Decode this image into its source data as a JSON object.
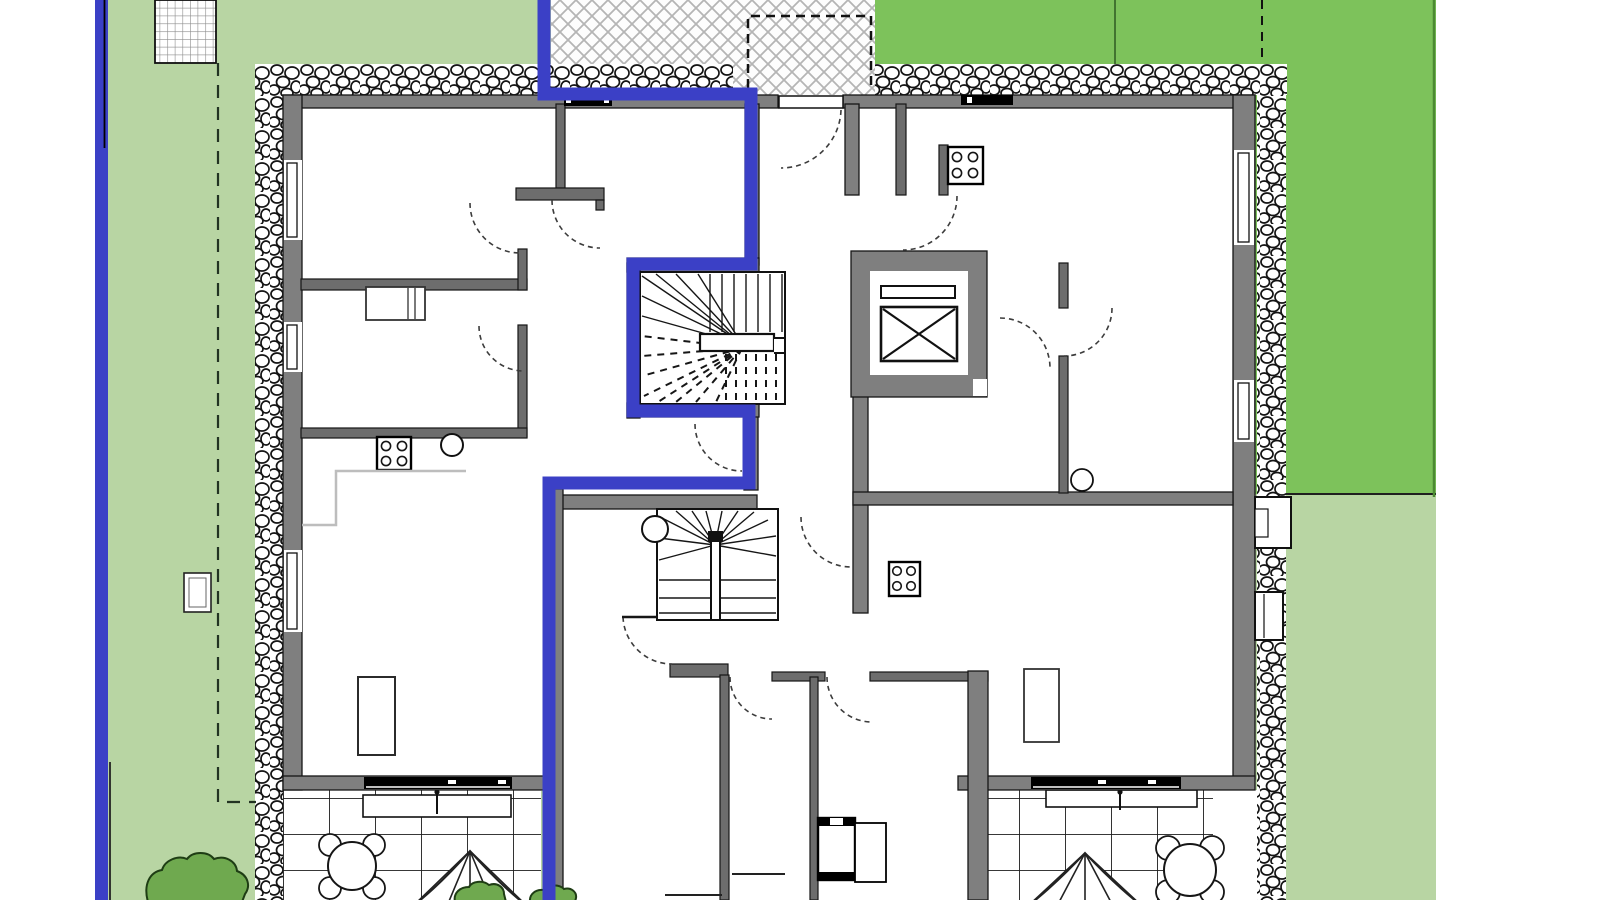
{
  "meta": {
    "kind": "architectural-floor-plan",
    "view": "ground floor site plan",
    "annotation": "left apartment unit and its terrace outlined in blue; no text labels visible in drawing"
  },
  "colors": {
    "lawn_light": "#b8d5a3",
    "lawn_dark": "#7dc25b",
    "wall": "#7f7f7f",
    "wall_dark": "#6d6d6d",
    "line": "#161616",
    "unit_outline": "#3b40c6",
    "counter": "#bdbdbd",
    "bush": "#6fa94f"
  },
  "legend": {
    "blue_polygon": "selected apartment unit boundary",
    "blue_left_band": "property boundary line",
    "hatched_area": "entrance terrace (diagonal lattice paving)",
    "pebble_band": "gravel strip surrounding the building",
    "lawn_light_area": "garden lawn",
    "lawn_dark_area": "adjacent lawn parcel",
    "dashed_lines": "setback / parcel limit lines",
    "tile_grid_areas": "ground-floor patios"
  },
  "inventory": {
    "stairwells": 2,
    "elevator": 1,
    "cooktops": 3,
    "sinks": 1,
    "door_swings": 12,
    "windows_left_wall": 3,
    "windows_right_wall": 2,
    "window_wells_right": 2,
    "sliding_glass_doors": 2,
    "top_wall_vents": 2,
    "patios": 2,
    "patio_tables": 2,
    "patio_chairs": 8,
    "patio_umbrellas": 2,
    "bushes": 3,
    "drain_grate": 1,
    "utility_box": 1
  }
}
